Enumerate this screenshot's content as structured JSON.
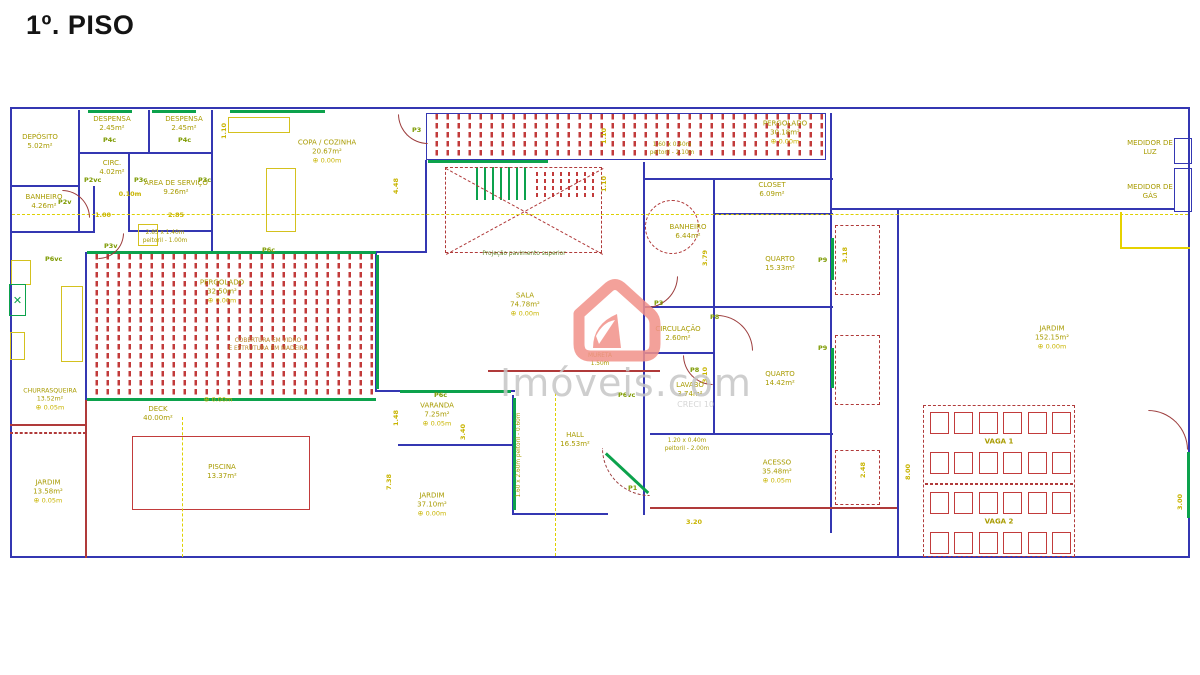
{
  "title": "1º. PISO",
  "icons": {
    "level_marker": "⊕",
    "grill": "✕"
  },
  "watermark": {
    "brand": "Imóveis.com",
    "creci": "CRECI 10",
    "icon": "house-logo",
    "color": "#f29189"
  },
  "rooms": {
    "deposito": {
      "name": "DEPÓSITO",
      "area": "5.02m²"
    },
    "despensa1": {
      "name": "DESPENSA",
      "area": "2.45m²"
    },
    "despensa2": {
      "name": "DESPENSA",
      "area": "2.45m²"
    },
    "circ": {
      "name": "CIRC.",
      "area": "4.02m²"
    },
    "area_servico": {
      "name": "ÁREA DE SERVIÇO",
      "area": "9.26m²"
    },
    "banheiro_servico": {
      "name": "BANHEIRO",
      "area": "4.26m²"
    },
    "copa_cozinha": {
      "name": "COPA / COZINHA",
      "area": "20.67m²",
      "level": "0.00m"
    },
    "pergolado_esq": {
      "name": "PERGOLADO",
      "area": "32.50m²",
      "level": "0.00m"
    },
    "pergolado_dir": {
      "name": "PERGOLADO",
      "area": "30.18m²",
      "level": "0.00m"
    },
    "sala": {
      "name": "SALA",
      "area": "74.78m²",
      "level": "0.00m"
    },
    "closet": {
      "name": "CLOSET",
      "area": "6.09m²"
    },
    "banheiro_suite": {
      "name": "BANHEIRO",
      "area": "6.44m²"
    },
    "circulacao": {
      "name": "CIRCULAÇÃO",
      "area": "2.60m²"
    },
    "quarto1": {
      "name": "QUARTO",
      "area": "15.33m²"
    },
    "quarto2": {
      "name": "QUARTO",
      "area": "14.42m²"
    },
    "lavabo": {
      "name": "LAVABO",
      "area": "3.74m²"
    },
    "hall": {
      "name": "HALL",
      "area": "16.53m²"
    },
    "varanda": {
      "name": "VARANDA",
      "area": "7.25m²",
      "level": "0.05m"
    },
    "jardim_frente": {
      "name": "JARDIM",
      "area": "37.10m²",
      "level": "0.00m"
    },
    "acesso": {
      "name": "ACESSO",
      "area": "35.48m²",
      "level": "0.05m"
    },
    "jardim_lateral": {
      "name": "JARDIM",
      "area": "152.15m²",
      "level": "0.00m"
    },
    "churrasqueira": {
      "name": "CHURRASQUEIRA",
      "area": "13.52m²",
      "level": "0.05m"
    },
    "deck": {
      "name": "DECK",
      "area": "40.00m²",
      "level": "0.00m"
    },
    "piscina": {
      "name": "PISCINA",
      "area": "13.37m²"
    },
    "jardim_fundos": {
      "name": "JARDIM",
      "area": "13.58m²",
      "level": "0.05m"
    },
    "vaga1": {
      "name": "VAGA 1"
    },
    "vaga2": {
      "name": "VAGA 2"
    },
    "medidor_luz": {
      "name": "MEDIDOR DE LUZ"
    },
    "medidor_gas": {
      "name": "MEDIDOR DE GÁS"
    }
  },
  "doors": {
    "p1": "P1",
    "p2v": "P2v",
    "p2vc": "P2vc",
    "p3": "P3",
    "p3c": "P3c",
    "p3v": "P3v",
    "p4c": "P4c",
    "p6c": "P6c",
    "p6vc": "P6vc",
    "p8": "P8",
    "p9": "P9"
  },
  "notes": {
    "window_servico_1": "2.85 x 1.40m",
    "window_servico_2": "peitoril - 1.00m",
    "window_suite_1": "1.60 x 0.40m",
    "window_suite_2": "peitoril - 2.10m",
    "window_lavabo_1": "1.20 x 0.40m",
    "window_lavabo_2": "peitoril - 2.00m",
    "window_hall": "1.60 x 2.60m  peitoril - 0.60m",
    "stair_projection": "Projeção pavimento superior",
    "mureta_label": "MURETA",
    "mureta_height": "1.50m",
    "pergolado_note_1": "COBERTURA EM VIDRO",
    "pergolado_note_2": "E ESTRUTURA EM MADEIRA"
  },
  "dims": {
    "d448": "4.48",
    "d110": "1.10",
    "d285": "2.85",
    "d100": "1.00",
    "d010": "0.10m",
    "d379": "3.79",
    "d318": "3.18",
    "d310": "3.10",
    "d148": "1.48",
    "d340": "3.40",
    "d320": "3.20",
    "d248": "2.48",
    "d800": "8.00",
    "d300": "3.00",
    "d738": "7.38"
  },
  "parking": {
    "rows": 4,
    "cols": 6
  },
  "colors": {
    "wall": "#3437b2",
    "accent_green": "#0ca24c",
    "hatch_red": "#c23b3b",
    "dash_red": "#b03a3a",
    "label_yellow": "#a89b00",
    "dim_yellow": "#c8b400",
    "watermark": "#f29189"
  }
}
